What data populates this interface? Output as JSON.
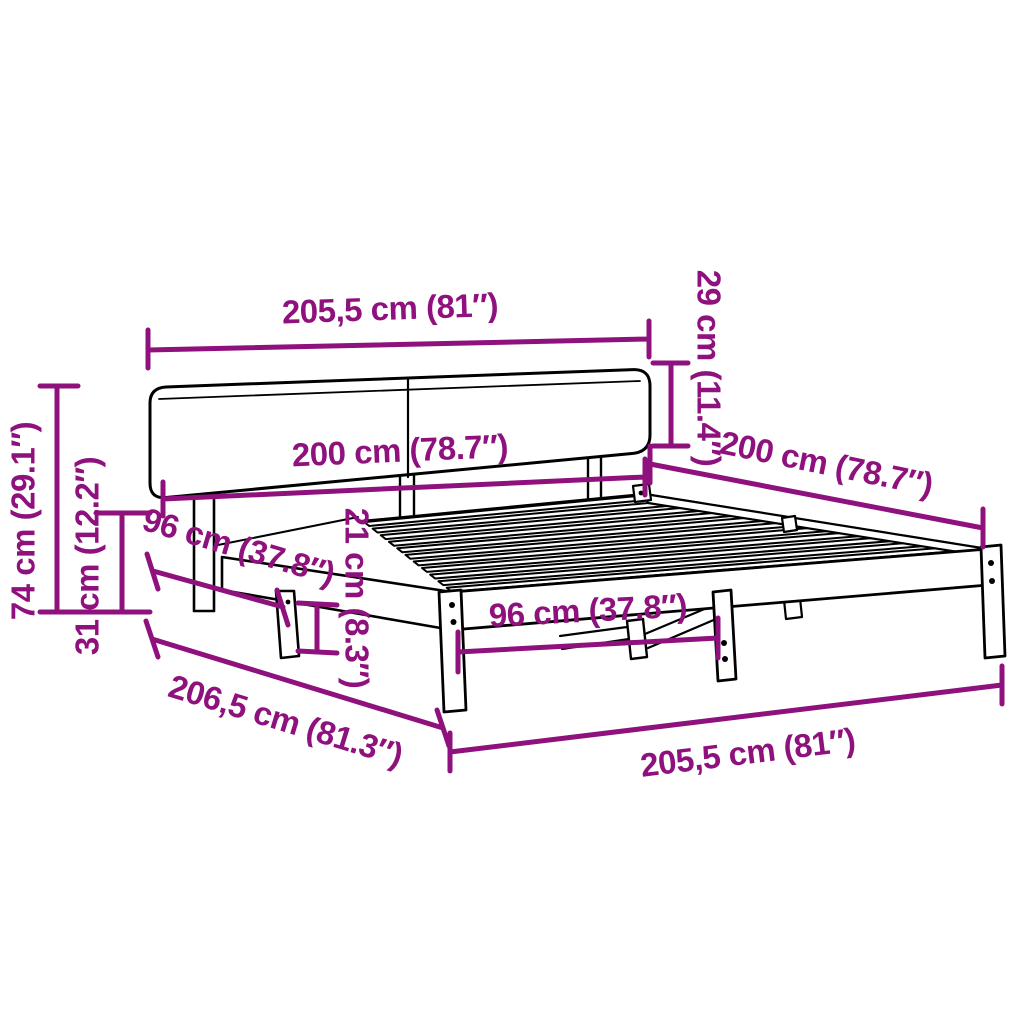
{
  "diagram": {
    "kind": "bed-frame-dimension-diagram",
    "colors": {
      "dimension": "#8F117D",
      "outline": "#000000",
      "background": "#FFFFFF"
    },
    "dimensions": {
      "headboard_width_top": "205,5 cm (81″)",
      "headboard_panel_height": "29 cm (11.4″)",
      "inner_width": "200 cm (78.7″)",
      "bed_length_right": "200 cm (78.7″)",
      "total_height": "74 cm (29.1″)",
      "base_height": "31 cm (12.2″)",
      "side_leg_spacing": "96 cm (37.8″)",
      "rail_height": "21 cm (8.3″)",
      "front_leg_spacing": "96 cm (37.8″)",
      "total_length": "206,5 cm (81.3″)",
      "total_width_bottom": "205,5 cm (81″)"
    }
  }
}
